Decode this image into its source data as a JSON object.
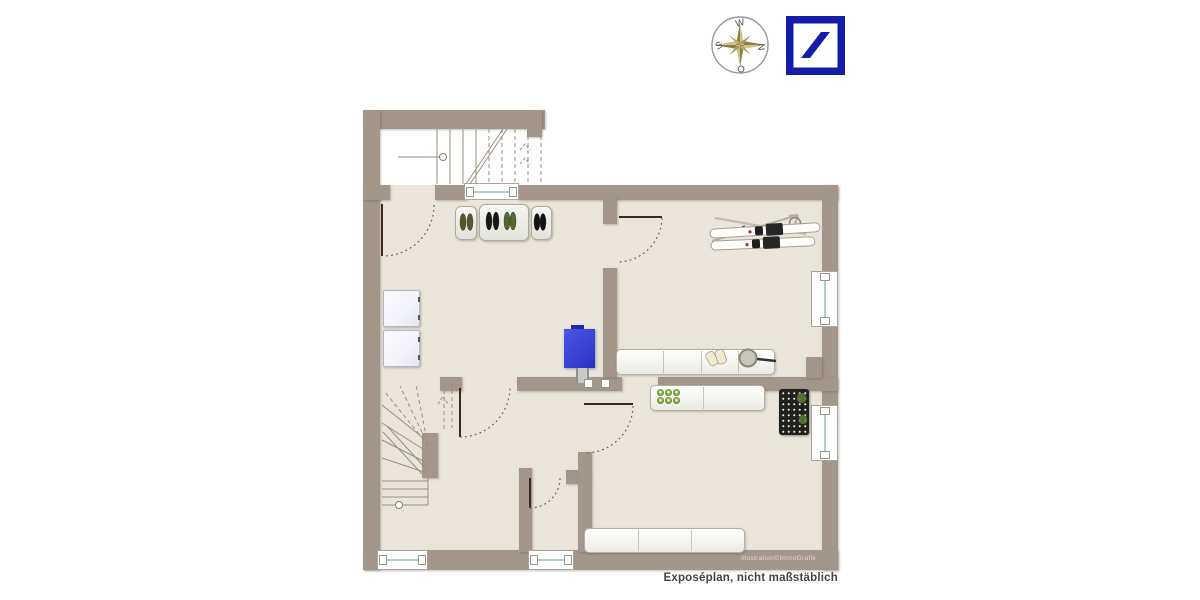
{
  "header": {
    "compass": {
      "top": "W",
      "right": "N",
      "bottom": "O",
      "left": "S"
    }
  },
  "plan": {
    "watermark": "Illustration©ImmoGrafik",
    "caption": "Exposéplan, nicht maßstäblich"
  },
  "colors": {
    "wall": "#a3968a",
    "floor": "#eae5da",
    "stairwell": "#ffffff",
    "glass": "#a8d2d2",
    "door": "#3c2a22",
    "arc": "#6f6257",
    "stair_line": "#9a8e80",
    "boiler": "#3a41d6",
    "boiler_dark": "#2127ad",
    "shelf_border": "#b2afa5",
    "wine_rack": "#20201c",
    "bottle_green": "#7fa43e",
    "compass_gold_light": "#cfc28c",
    "compass_gold_dark": "#8b7d45",
    "db_blue": "#141ca8",
    "caption_text": "#4a433c",
    "appliance": "#f2f2fa"
  }
}
